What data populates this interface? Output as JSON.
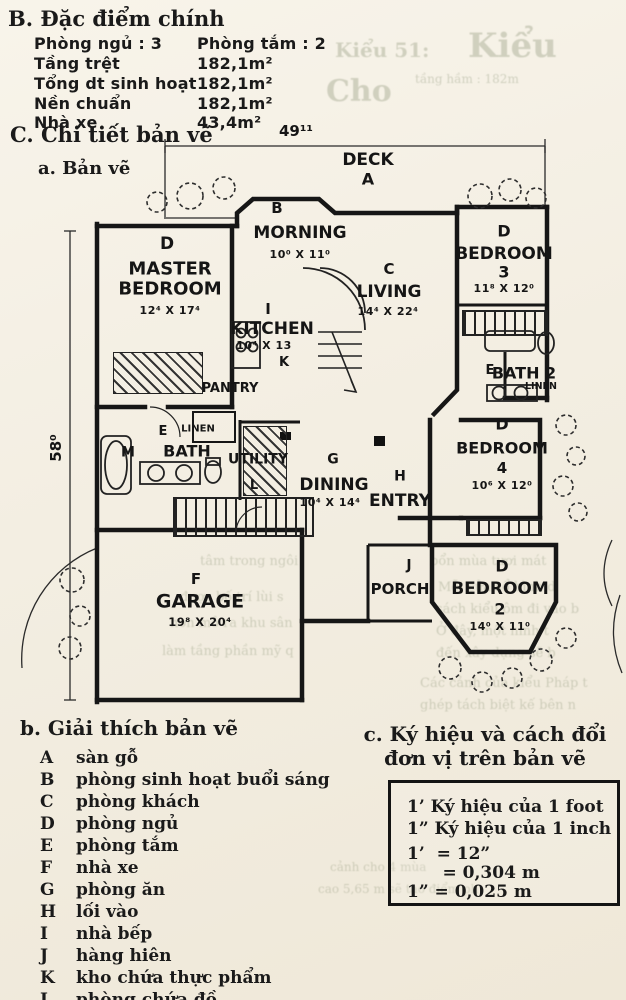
{
  "header": {
    "section_b_heading": "B. Đặc điểm chính",
    "rows": [
      {
        "label": "Phòng ngủ : 3",
        "value": "Phòng tắm : 2"
      },
      {
        "label": "Tầng trệt",
        "value": "182,1m²"
      },
      {
        "label": "Tổng dt sinh hoạt",
        "value": "182,1m²"
      },
      {
        "label": "Nền chuẩn",
        "value": "182,1m²"
      },
      {
        "label": "Nhà xe",
        "value": "43,4m²"
      }
    ],
    "section_c_heading": "C. Chi tiết bản vẽ",
    "sub_a_heading": "a. Bản vẽ"
  },
  "plan": {
    "dim_top": "49¹¹",
    "dim_left": "58⁰",
    "deck": {
      "name": "DECK",
      "letter": "A"
    },
    "morning": {
      "letter": "B",
      "name": "MORNING",
      "dims": "10⁰ X 11⁰"
    },
    "master": {
      "letter": "D",
      "name1": "MASTER",
      "name2": "BEDROOM",
      "dims": "12⁴ X 17⁴"
    },
    "living": {
      "letter": "C",
      "name": "LIVING",
      "dims": "14⁴ X 22⁴"
    },
    "bedroom3": {
      "letter": "D",
      "name": "BEDROOM",
      "number": "3",
      "dims": "11⁸ X 12⁰"
    },
    "kitchen": {
      "letter": "I",
      "name": "KITCHEN",
      "dims": "10⁴ X 13"
    },
    "pantry": {
      "letter": "K",
      "name": "PANTRY"
    },
    "bath2": {
      "letter": "E",
      "name": "BATH 2",
      "closet": "LINEN"
    },
    "bath_main": {
      "letter": "E",
      "closet": "LINEN",
      "m": "M",
      "name": "BATH"
    },
    "utility": {
      "name": "UTILITY",
      "letter": "L"
    },
    "dining": {
      "letter": "G",
      "name": "DINING",
      "dims": "10⁴ X 14⁴"
    },
    "entry": {
      "letter": "H",
      "name": "ENTRY"
    },
    "bedroom4": {
      "letter": "D",
      "name": "BEDROOM",
      "number": "4",
      "dims": "10⁶ X 12⁰"
    },
    "garage": {
      "letter": "F",
      "name": "GARAGE",
      "dims": "19⁸ X 20⁴"
    },
    "porch": {
      "letter": "J",
      "name": "PORCH"
    },
    "bedroom2": {
      "letter": "D",
      "name": "BEDROOM",
      "number": "2",
      "dims": "14⁰ X 11⁰"
    }
  },
  "legend": {
    "heading": "b. Giải thích bản vẽ",
    "items": [
      {
        "key": "A",
        "text": "sàn gỗ"
      },
      {
        "key": "B",
        "text": "phòng sinh hoạt buổi sáng"
      },
      {
        "key": "C",
        "text": "phòng khách"
      },
      {
        "key": "D",
        "text": "phòng ngủ"
      },
      {
        "key": "E",
        "text": "phòng tắm"
      },
      {
        "key": "F",
        "text": "nhà xe"
      },
      {
        "key": "G",
        "text": "phòng ăn"
      },
      {
        "key": "H",
        "text": "lối vào"
      },
      {
        "key": "I",
        "text": "nhà bếp"
      },
      {
        "key": "J",
        "text": "hàng hiên"
      },
      {
        "key": "K",
        "text": "kho chứa thực phẩm"
      },
      {
        "key": "L",
        "text": "phòng chứa đồ"
      }
    ]
  },
  "units": {
    "heading1": "c. Ký hiệu và cách đổi",
    "heading2": "đơn vị trên bản vẽ",
    "lines": [
      "1’ Ký hiệu của 1 foot",
      "1” Ký hiệu của 1 inch",
      "1’  = 12”",
      "      = 0,304 m",
      "1” = 0,025 m"
    ]
  },
  "ghost": [
    "Kiểu 51:",
    "Kiểu",
    "Cho",
    "tầng hầm : 182m",
    "bổn mùa tươi mát",
    "Mỗi cửa sổ hình d",
    "sách kiểu ôm đi vào b",
    "Ở đây, một hình t",
    "đến xây dựng sẽ b",
    "Các cảnh của kiểu Pháp t",
    "ghép tách biệt kế bên n",
    "tâm trong ngôi",
    "được bố trí lùi s",
    "hơn mở ra khu sân",
    "làm tầng phần mỹ q",
    "cảnh cho 4 mùa",
    "cao 5,65 m sẽ tạo điểm ph"
  ]
}
